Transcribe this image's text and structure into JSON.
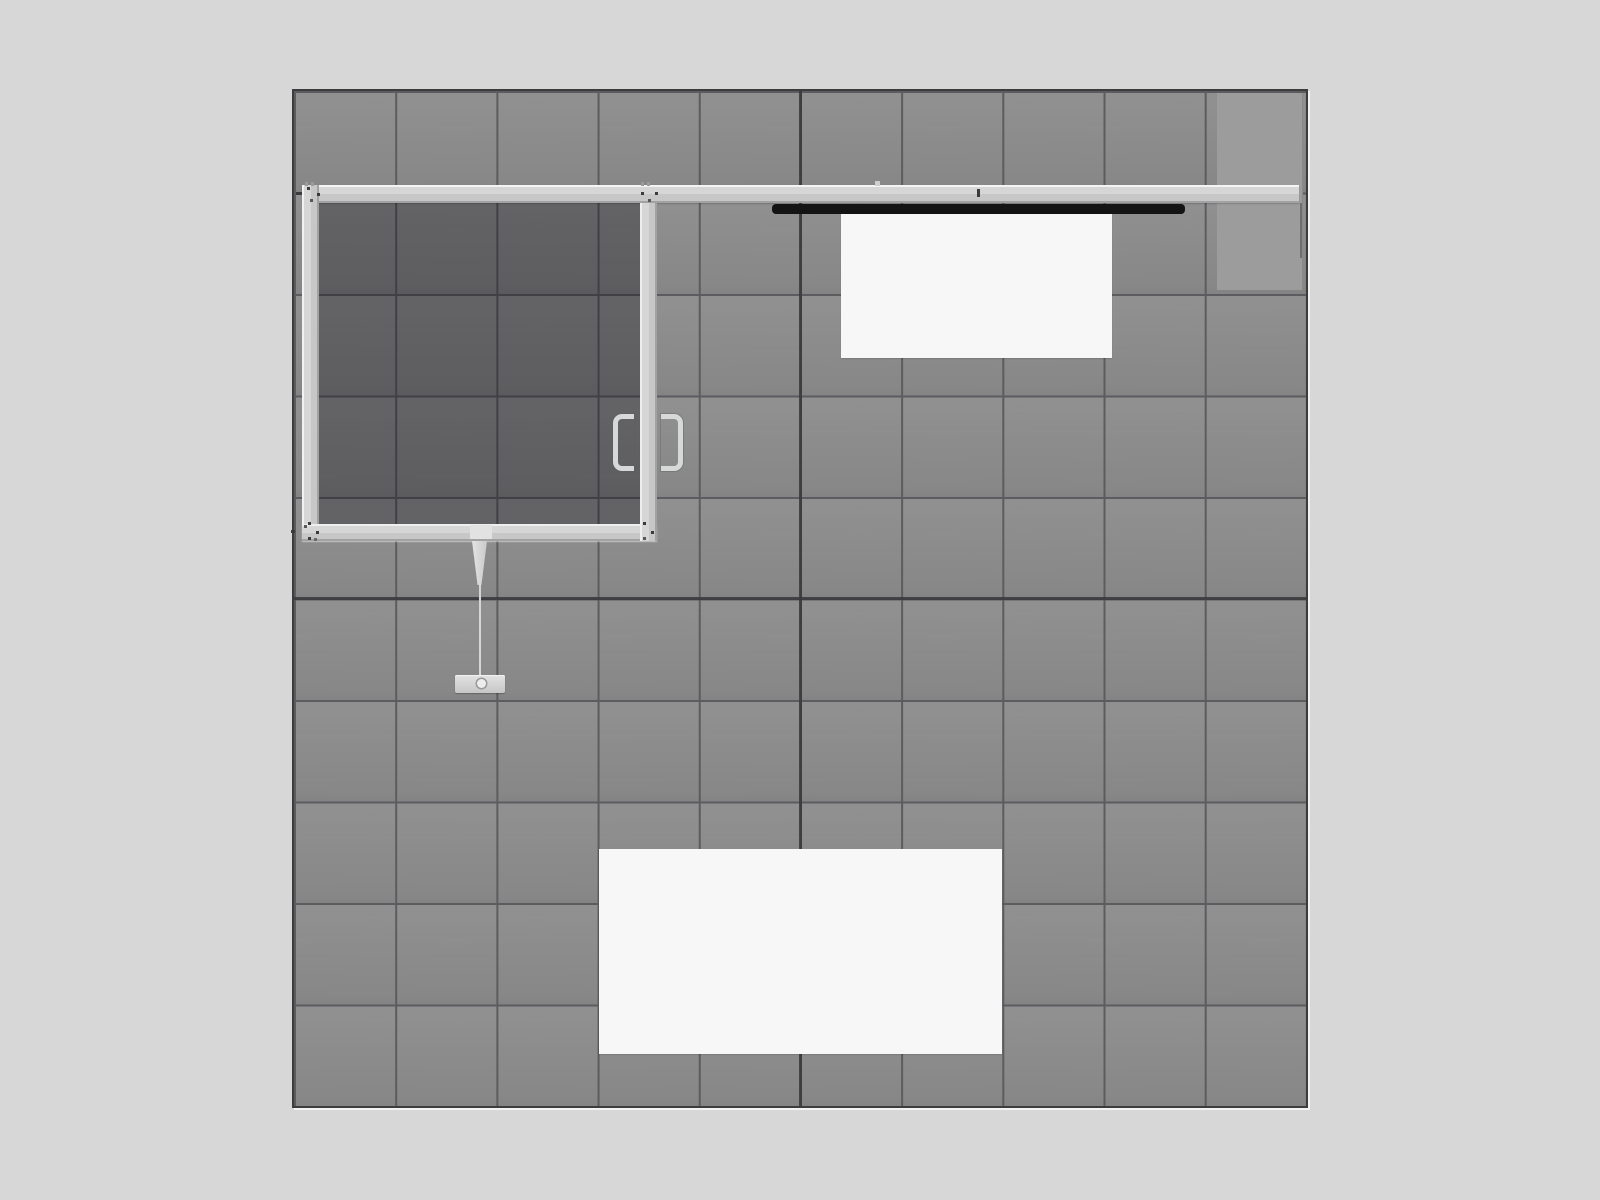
{
  "grid": {
    "columns": 10,
    "rows": 10
  },
  "colors": {
    "canvas-bg": "#d7d7d7",
    "tile": "#8a8a8a",
    "grid-line": "#5c5c60",
    "seam": "#38383c",
    "booth-border": "#3c3c3c",
    "frame-hi": "#f1f1f1",
    "frame-mid": "#d6d6d6",
    "frame-base": "#c7c7c8",
    "frame-edge": "#a2a2a4",
    "interior-shade": "rgba(10,10,14,0.33)",
    "raised-panel": "#9c9c9c",
    "mount-bar": "#141414",
    "panel-white": "#f7f7f7",
    "pendant": "#d6d6d6",
    "handle": "#d6d9d8",
    "bolt": "#3b3b3e",
    "notch": "#9b9b9b"
  }
}
